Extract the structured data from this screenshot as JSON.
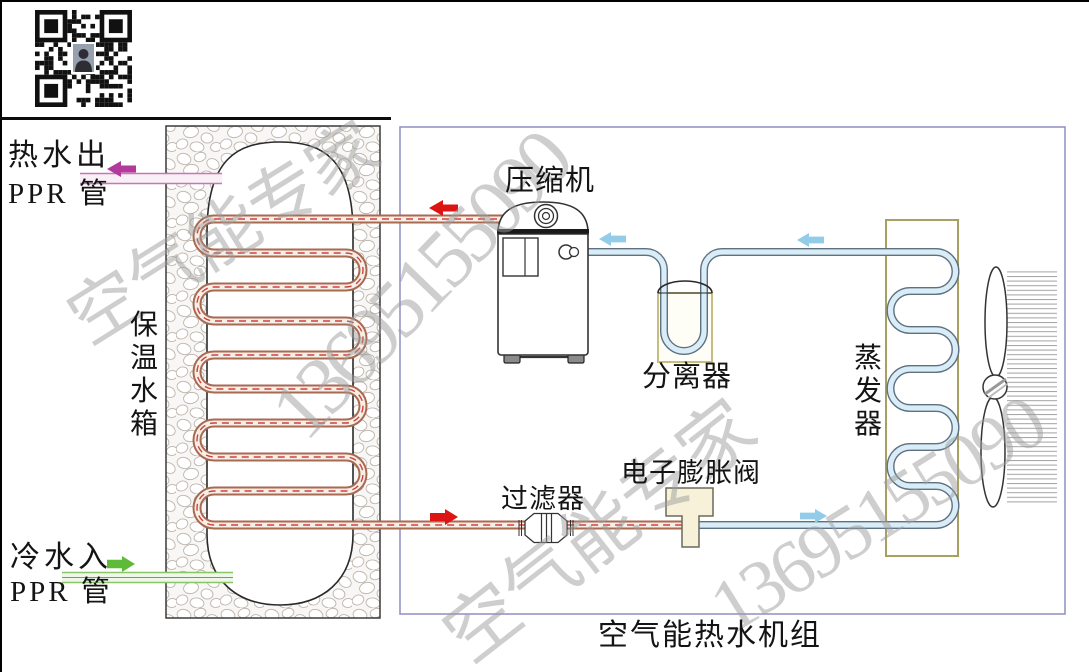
{
  "labels": {
    "hot_water_out": "热水出",
    "hot_water_pipe_type": "PPR 管",
    "cold_water_in": "冷水入",
    "cold_water_pipe_type": "PPR 管",
    "tank": "保温水箱",
    "compressor": "压缩机",
    "separator": "分离器",
    "evaporator": "蒸发器",
    "filter": "过滤器",
    "expansion_valve": "电子膨胀阀",
    "unit_title": "空气能热水机组"
  },
  "watermark": {
    "brand": "空气能专家",
    "phone": "13695155090"
  },
  "colors": {
    "hot_water_arrow": "#b23a9a",
    "cold_water_arrow": "#5fba38",
    "hot_refrigerant_arrow": "#dc1414",
    "cold_refrigerant_arrow": "#93cce9",
    "copper_pipe": "#a86a50",
    "cold_pipe_fill": "#d8edf7",
    "component_border": "#b8b070",
    "enclosure_border": "#9494c6",
    "watermark_gray": "#9e9e9e"
  },
  "flow_arrows": [
    {
      "name": "hot-water-out-arrow",
      "direction": "left",
      "color": "#b23a9a"
    },
    {
      "name": "compressor-discharge-arrow",
      "direction": "left",
      "color": "#dc1414"
    },
    {
      "name": "suction-to-compressor-arrow",
      "direction": "left",
      "color": "#93cce9"
    },
    {
      "name": "evaporator-to-separator-arrow",
      "direction": "left",
      "color": "#93cce9"
    },
    {
      "name": "tank-liquid-out-arrow",
      "direction": "right",
      "color": "#dc1414"
    },
    {
      "name": "expansion-to-evaporator-arrow",
      "direction": "right",
      "color": "#93cce9"
    },
    {
      "name": "cold-water-in-arrow",
      "direction": "right",
      "color": "#5fba38"
    }
  ]
}
